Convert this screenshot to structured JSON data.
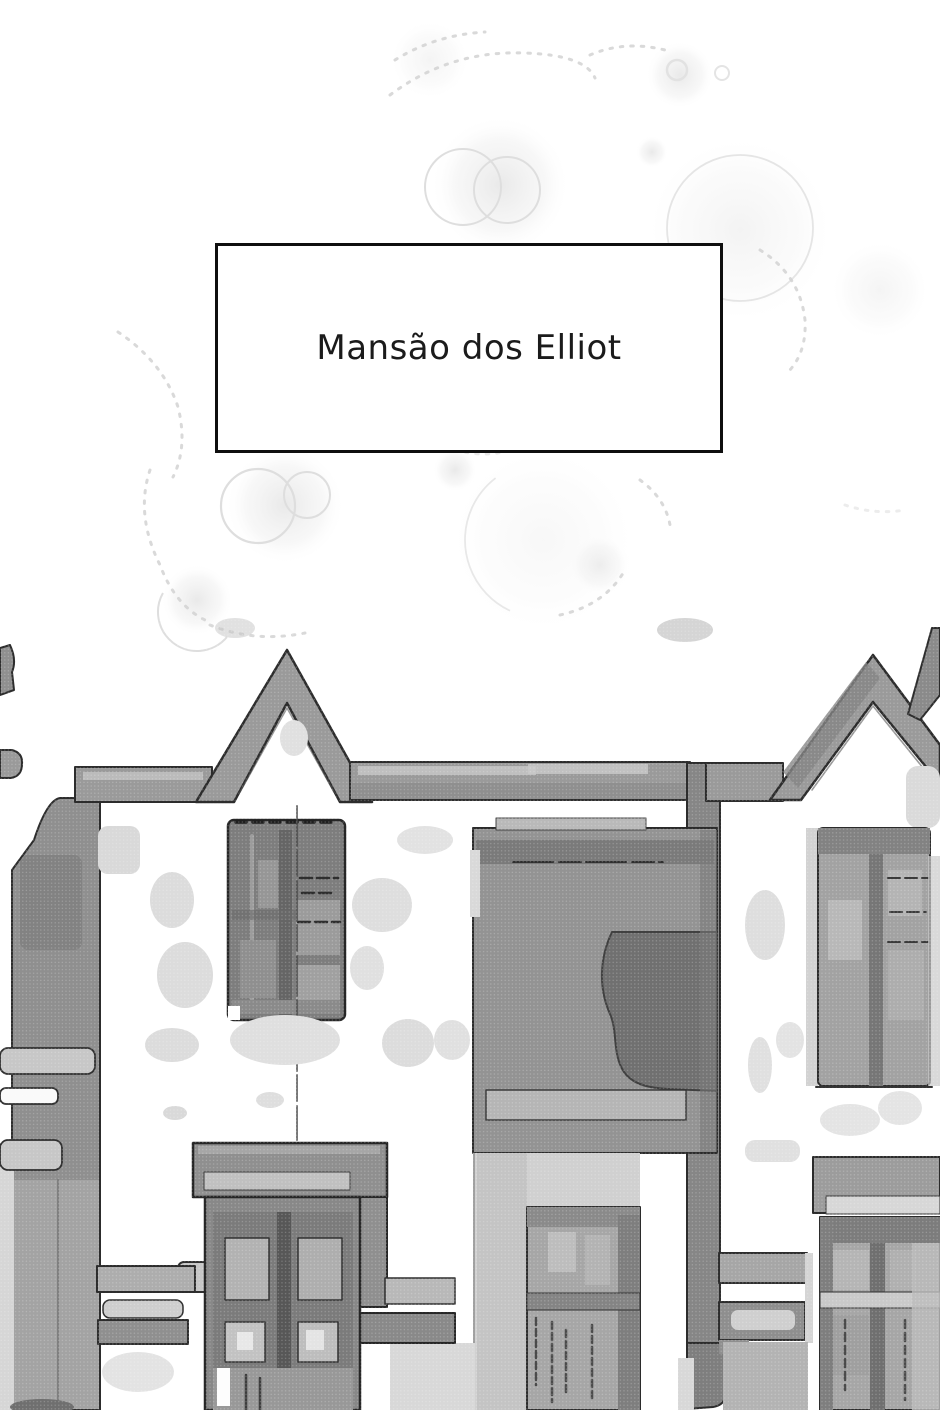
{
  "page": {
    "kind": "comic-page",
    "background": "#ffffff",
    "width": 940,
    "height": 1410
  },
  "caption_box": {
    "text": "Mansão dos Elliot",
    "border_color": "#0f0f0f",
    "background": "#ffffff",
    "text_color": "#1b1b1b"
  },
  "illustration": {
    "alt": "Grayscale watercolor-and-ink sketch of the Elliot family mansion facade: two gabled rooflines, tall mullioned windows, a dark recessed wall panel, a double entrance door, halftone dot shading and faint sparkle bokeh above",
    "palette": {
      "outline": "#2b2b2b",
      "roof": "#9a9a9a",
      "eave": "#9a9a9a",
      "column": "#8f8f8f",
      "pillar": "#868686",
      "panel": "#939393",
      "panel_dark": "#6e6e6e",
      "window_dark": "#7d7d7d",
      "window_mid": "#a6a6a6",
      "door": "#7b7b7b",
      "lintel": "#8f8f8f",
      "wash_light": "#dcdcdc",
      "sparkle": "#dedede"
    }
  }
}
